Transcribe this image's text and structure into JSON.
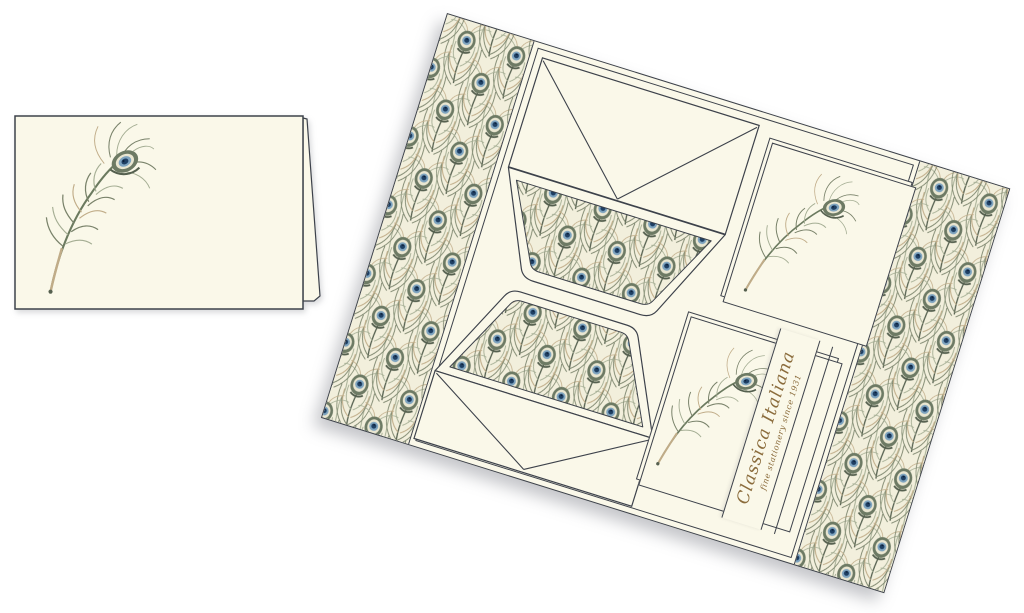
{
  "box": {
    "band": {
      "title": "Classica Italiana",
      "subtitle": "fine stationery since 1931"
    }
  },
  "icons": {
    "feather_icon": "peacock-feather-illustration",
    "pattern_swatch": "peacock-eye-feather-pattern"
  },
  "theme": {
    "page_bg": "#ffffff",
    "paper": "#faf8e9",
    "outline": "#3d424b",
    "band_text": "#8b6c3c",
    "pat_bg": "#f2efdc",
    "eye_outer": "#6d7a64",
    "eye_pale": "#e9e6d1",
    "eye_blue": "#7da3bf",
    "eye_navy": "#1e3f63",
    "eye_dot": "#0b1e38",
    "barb_dark": "#55604f",
    "barb_olive": "#79826a",
    "barb_tan": "#c0ac88",
    "barb_sage": "#a4ad93",
    "stem": "#6b7a5f"
  }
}
